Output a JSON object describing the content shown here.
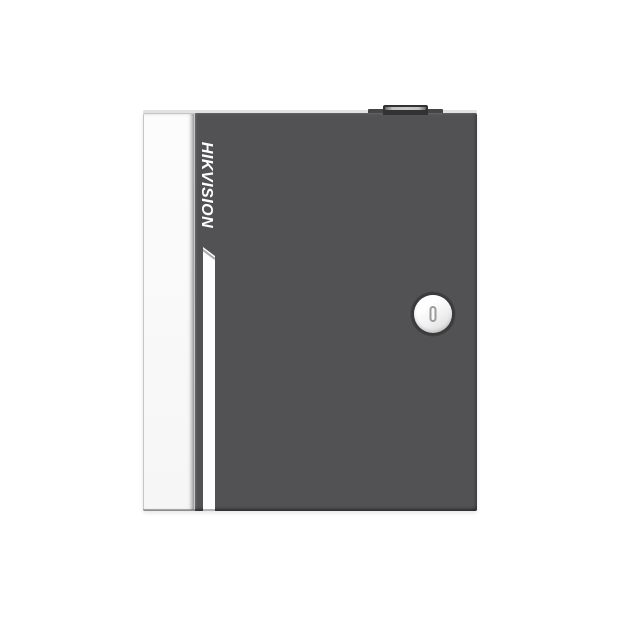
{
  "product": {
    "brand": "HIKVISION"
  },
  "icons": {
    "keyhole_slot": "vertical-slot"
  },
  "colors": {
    "background": "#ffffff",
    "door": "#525254",
    "side_panel": "#fcfcfc",
    "panel_border": "#c5c5c5",
    "stripe": "#fdfdfd",
    "top_edge": "#e2e2e2",
    "knob_base": "#454547",
    "knob_cap": "#323234",
    "knob_highlight": "#c0c0c0",
    "lock_face": "#ffffff",
    "lock_ring": "#3b3b3d",
    "lock_slot": "#9b9b9b",
    "logo_text": "#ffffff"
  }
}
